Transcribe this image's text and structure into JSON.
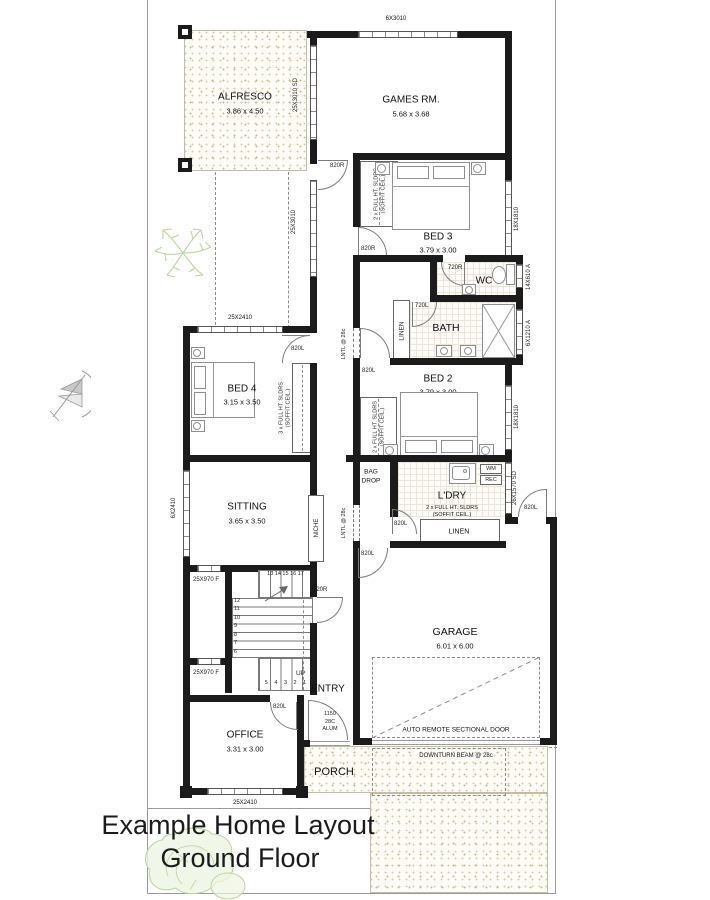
{
  "title": {
    "line1": "Example Home Layout",
    "line2": "Ground Floor"
  },
  "rooms": {
    "alfresco": {
      "name": "ALFRESCO",
      "dims": "3.86 x 4.50"
    },
    "games": {
      "name": "GAMES RM.",
      "dims": "5.68 x 3.68"
    },
    "bed3": {
      "name": "BED 3",
      "dims": "3.79 x 3.00"
    },
    "bed2": {
      "name": "BED 2",
      "dims": "3.79 x 3.00"
    },
    "bed4": {
      "name": "BED 4",
      "dims": "3.15 x 3.50"
    },
    "sitting": {
      "name": "SITTING",
      "dims": "3.65 x 3.50"
    },
    "office": {
      "name": "OFFICE",
      "dims": "3.31 x 3.00"
    },
    "garage": {
      "name": "GARAGE",
      "dims": "6.01 x 6.00"
    },
    "wc": "WC",
    "bath": "BATH",
    "ldry": "L'DRY",
    "entry": "ENTRY",
    "porch": "PORCH"
  },
  "labels": {
    "linen": "LINEN",
    "niche": "NICHE",
    "bag1": "BAG",
    "bag2": "DROP",
    "wm": "WM",
    "rec": "REC",
    "lntl": "LNTL @ 28c",
    "auto_door": "AUTO REMOTE SECTIONAL DOOR",
    "beam": "DOWNTURN BEAM @ 28c",
    "sldrs2": "2 x FULL HT. SLDRS",
    "sldrs3": "3 x FULL HT. SLDRS",
    "soffit": "(SOFFIT CEIL.)"
  },
  "windows": {
    "w6x3010": "6X3010",
    "w25x3010sd": "25X3010 SD",
    "w25x3010": "25X3010",
    "w18x1810": "18X1810",
    "w14x610": "14X610 A",
    "w6x1210": "6X1210 A",
    "w26x1570": "26X1570 SD",
    "w25x2410": "25X2410",
    "w6x2410": "6X2410",
    "w25x970": "25X970 F"
  },
  "doors": {
    "r820": "820R",
    "l820": "820L",
    "r720": "720R",
    "l720": "720L",
    "front": [
      "1150",
      "28C",
      "ALUM"
    ]
  },
  "stairs": {
    "top_row": "13 14 15 16 17",
    "col": [
      "12",
      "11",
      "10",
      "9",
      "8",
      "7",
      "6"
    ],
    "bottom_row": "5 4 3 2 1",
    "up": "UP"
  }
}
